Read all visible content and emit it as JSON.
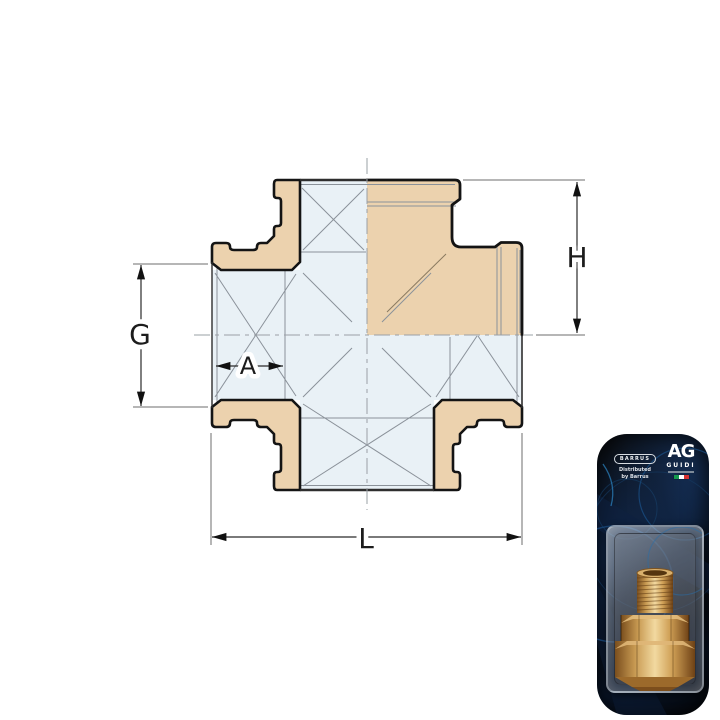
{
  "diagram": {
    "type": "technical-drawing-cross-pipe-fitting",
    "labels": {
      "G": "G",
      "H": "H",
      "A": "A",
      "L": "L"
    },
    "colors": {
      "fitting_section": "#ecd2ae",
      "fitting_bore": "#e9f1f6",
      "outline": "#141414",
      "thin_line": "#8a9199",
      "dimension_line": "#2b2b2b",
      "center_line": "#9aa0a6"
    }
  },
  "packaging": {
    "distributor_logo": "BARRUS",
    "distributed_line1": "Distributed",
    "distributed_line2": "by Barrus",
    "brand_logo": "AG",
    "brand_name": "GUIDI",
    "flag_colors": [
      "#169b4e",
      "#ffffff",
      "#d6302e"
    ],
    "colors": {
      "card_background": "#0a1526",
      "accent_blue": "#2fa7e0",
      "brass": "#c9964f"
    }
  }
}
